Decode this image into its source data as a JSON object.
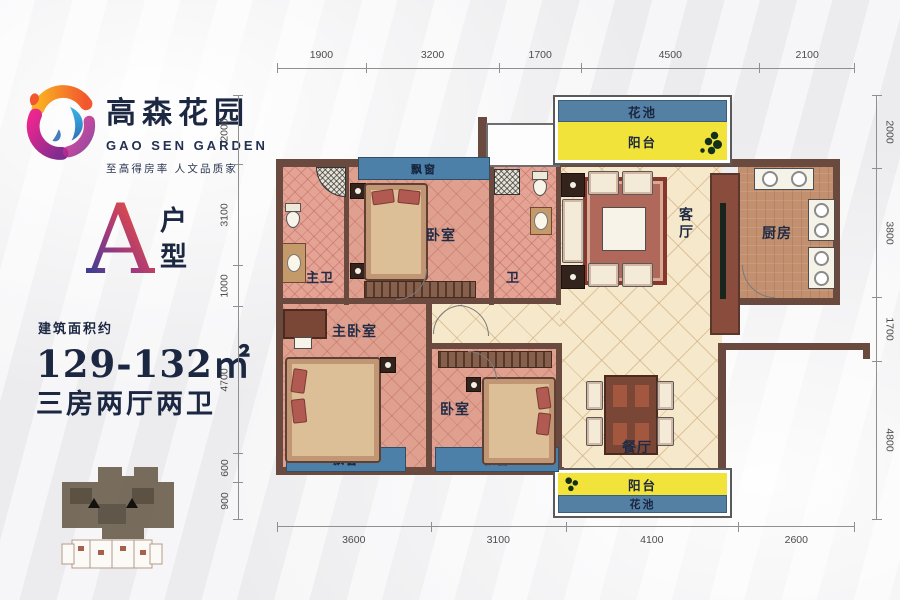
{
  "brand": {
    "name_cn": "高森花园",
    "name_en": "GAO SEN GARDEN",
    "slogan": "至高得房率  人文品质家"
  },
  "unit": {
    "type_letter": "A",
    "type_label": "户型",
    "area_prefix": "建筑面积约",
    "area_value": "129-132㎡",
    "rooms_summary": "三房两厅两卫"
  },
  "dimensions": {
    "top": [
      "1900",
      "3200",
      "1700",
      "4500",
      "2100"
    ],
    "bottom": [
      "3600",
      "3100",
      "4100",
      "2600"
    ],
    "left": [
      "2000",
      "3100",
      "1000",
      "4700",
      "600",
      "900"
    ],
    "right": [
      "2000",
      "3800",
      "1700",
      "4800"
    ]
  },
  "rooms": {
    "balcony": "阳台",
    "flower_bed": "花池",
    "bay_window": "飘窗",
    "master_bath": "主卫",
    "bath": "卫",
    "bedroom": "卧室",
    "master_bedroom": "主卧室",
    "living_room": "客厅",
    "dining_room": "餐厅",
    "kitchen": "厨房"
  },
  "colors": {
    "accent_navy": "#1c2742",
    "bay_window_blue": "#4c80a8",
    "balcony_yellow": "#f2e33a",
    "wall_brown": "#6a4a3e",
    "bedroom_floor": "#dfa08f",
    "hall_floor": "#f6e8cb",
    "kitchen_floor": "#c3906f"
  }
}
